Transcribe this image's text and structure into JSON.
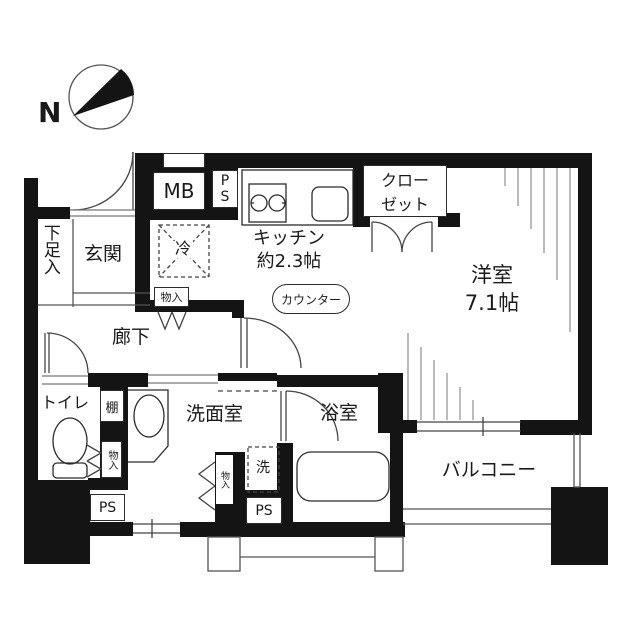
{
  "compass": {
    "north_label": "N"
  },
  "labels": {
    "shoe_cabinet": "下足入",
    "entrance": "玄関",
    "meter_box": "MB",
    "pipe_space_top": "PS",
    "refrigerator": "冷",
    "kitchen_name": "キッチン",
    "kitchen_size": "約2.3帖",
    "closet_line1": "クロー",
    "closet_line2": "ゼット",
    "western_room_name": "洋室",
    "western_room_size": "7.1帖",
    "counter": "カウンター",
    "hallway": "廊下",
    "storage_hallway": "物入",
    "toilet": "トイレ",
    "shelf": "棚",
    "storage_toilet": "物入",
    "pipe_space_left": "PS",
    "washroom": "洗面室",
    "storage_washroom": "物入",
    "washer": "洗",
    "pipe_space_bath": "PS",
    "bathroom": "浴室",
    "balcony": "バルコニー"
  },
  "colors": {
    "wall": "#141414",
    "line": "#3a3a3a",
    "background": "#ffffff"
  }
}
